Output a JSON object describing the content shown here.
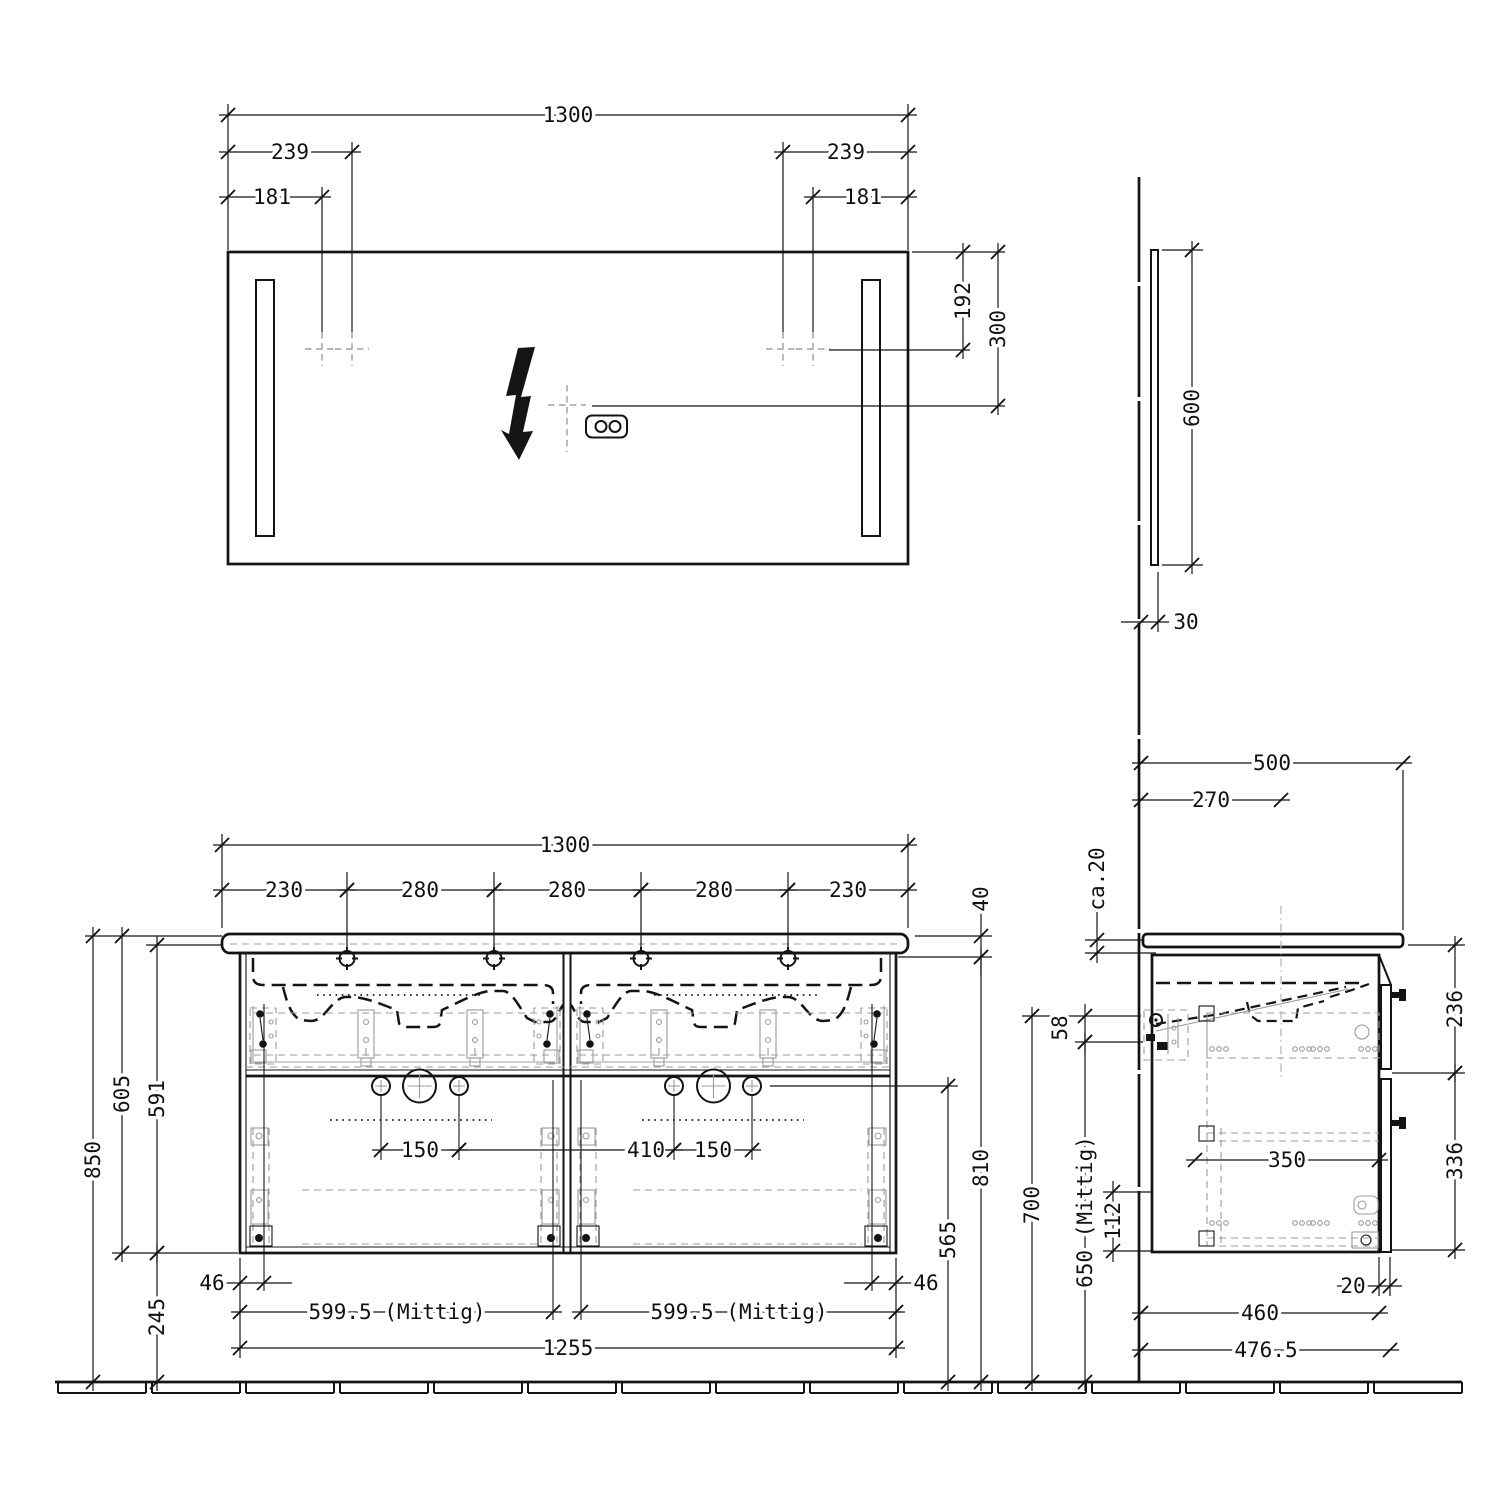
{
  "views": {
    "mirror_front": {
      "width": "1300",
      "lamp_offset_outer_left": "239",
      "lamp_offset_inner_left": "181",
      "lamp_offset_outer_right": "239",
      "lamp_offset_inner_right": "181",
      "lamp_center_height": "192",
      "socket_center_height": "300"
    },
    "mirror_side": {
      "height": "600",
      "depth": "30"
    },
    "vanity_front": {
      "width": "1300",
      "top_segments": [
        "230",
        "280",
        "280",
        "280",
        "230"
      ],
      "basin_thickness": "40",
      "height_total": "850",
      "height_basin_top": "605",
      "height_cabinet": "591",
      "height_floor_gap": "245",
      "hole_spacing_left": "150",
      "hole_spacing_mid": "410",
      "hole_spacing_right": "150",
      "hinge_offset_left": "46",
      "hinge_offset_right": "46",
      "basin_center_left": "599.5 (Mittig)",
      "basin_center_right": "599.5 (Mittig)",
      "cabinet_width": "1255",
      "height_drawer_split": "565",
      "height_cabinet_top": "810",
      "height_fitting": "700",
      "height_drain_center": "650 (Mittig)",
      "fitting_offset": "58",
      "bottom_fitting_offset": "112"
    },
    "vanity_side": {
      "depth_total": "500",
      "depth_center": "270",
      "wall_gap": "ca.20",
      "height_upper_drawer": "236",
      "height_lower_drawer": "336",
      "drawer_depth": "350",
      "front_thickness": "20",
      "depth_carcass": "460",
      "depth_with_front": "476.5"
    }
  }
}
